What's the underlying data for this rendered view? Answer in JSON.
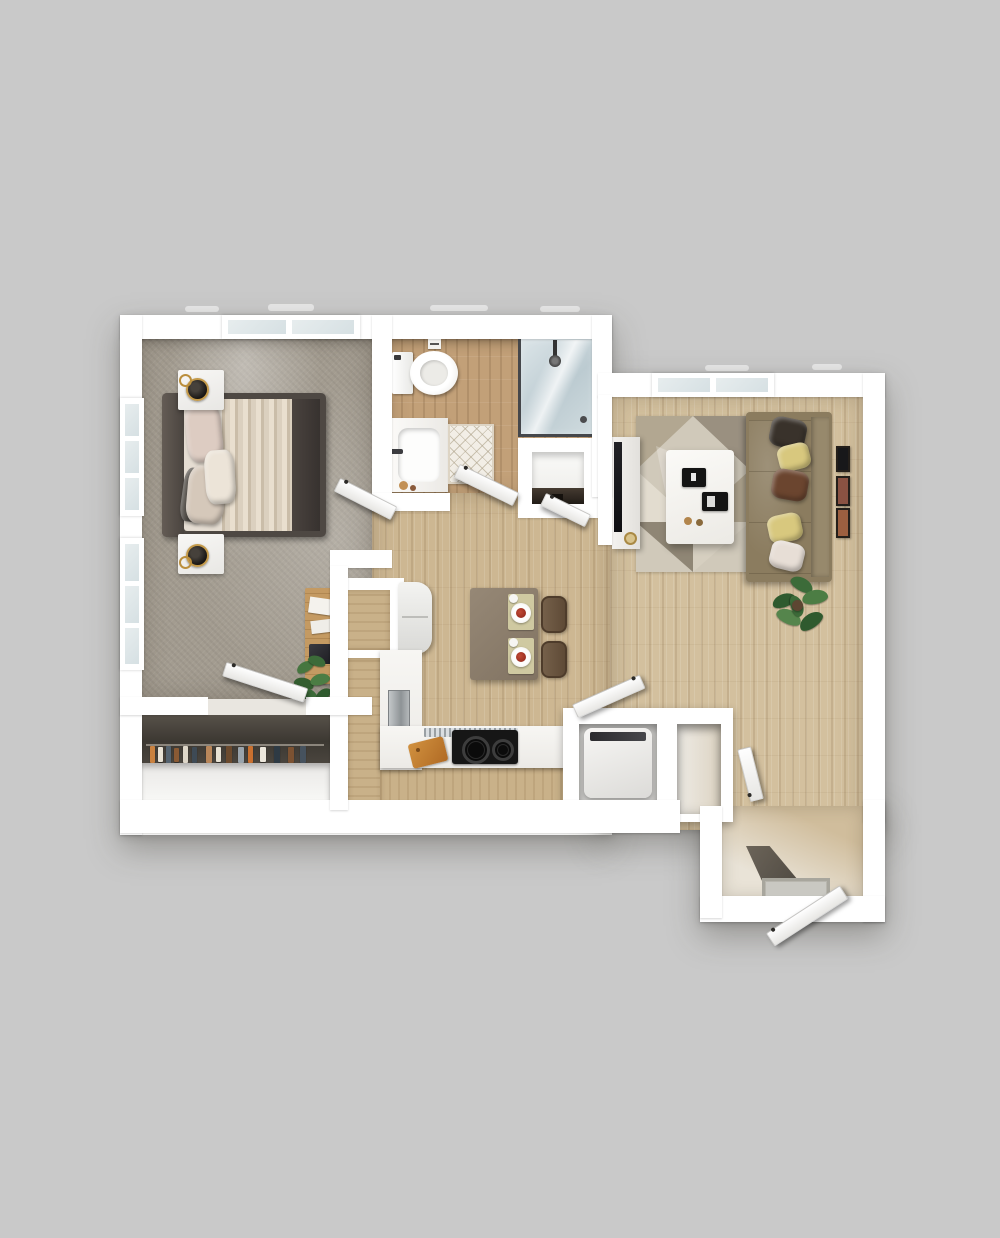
{
  "scene": {
    "description": "3D top-down rendered floor plan of a one-bedroom, one-bathroom apartment",
    "view": "top-down 3D render",
    "background_color": "#c9c9c9"
  },
  "palette": {
    "wall_white": "#ffffff",
    "bedroom_carpet_gray": "#a39c90",
    "hall_wood": "#cdb792",
    "living_wood": "#d3c09e",
    "bath_wood": "#c2a078",
    "shower_glass_blue": "#c9d6db",
    "sofa_olive": "#a29377",
    "pillow_yellow": "#d8c87e",
    "pillow_brown": "#6b452f",
    "dining_table_brown": "#8e8070",
    "cabinet_tan": "#c9b189",
    "cooktop_black": "#161616",
    "cutting_board_orange": "#c57f33",
    "plant_green": "#3c6b39"
  },
  "rooms": [
    {
      "id": "bedroom",
      "name": "Bedroom"
    },
    {
      "id": "bathroom",
      "name": "Bathroom"
    },
    {
      "id": "walk-in-closet",
      "name": "Walk-in Closet"
    },
    {
      "id": "linen-closet",
      "name": "Linen Closet"
    },
    {
      "id": "hall-dining",
      "name": "Hall / Dining Area"
    },
    {
      "id": "kitchen",
      "name": "Kitchen"
    },
    {
      "id": "laundry-closet",
      "name": "Laundry Closet"
    },
    {
      "id": "coat-closet",
      "name": "Coat Closet"
    },
    {
      "id": "living-room",
      "name": "Living Room"
    },
    {
      "id": "entry",
      "name": "Entry"
    }
  ],
  "furniture": {
    "bed": "Bed with upholstered frame, layered duvet and pillows",
    "nightstand": "Nightstand with black-and-gold table lamp",
    "desk": "Wood desk with papers and laptop",
    "desk_plant": "Potted plant beside desk",
    "closet_clothes": "Closet rod with hanging clothes",
    "toilet": "Toilet",
    "vanity": "Vanity with sink and faucet",
    "shower": "Glass walk-in shower with rain head",
    "bath_rug": "Diamond-lattice bath rug",
    "linen_shelf": "Linen closet shelf",
    "pantry": "Pantry nook",
    "fridge": "Refrigerator",
    "dishwasher": "Dishwasher",
    "counter": "Kitchen counter",
    "dish_rack": "Dish drying rack",
    "cutting_board": "Cutting board",
    "cooktop": "Two-burner cooktop",
    "dining_table": "Dining table for two",
    "dining_chair": "Dining chair",
    "place_setting": "Place setting with plate and cup",
    "washer": "Washer / dryer unit",
    "media_console": "Media console",
    "tv": "Wall-mounted TV",
    "area_rug": "Geometric-pattern area rug",
    "coffee_table": "White coffee table with black trays",
    "sofa": "Three-seat sofa with throw pillows",
    "living_plant": "Potted fiddle-leaf plant",
    "wall_art": "Framed wall art",
    "window": "Window",
    "interior_door": "Interior swing door",
    "front_door": "Front entry door",
    "doormat": "Entry doormat"
  }
}
